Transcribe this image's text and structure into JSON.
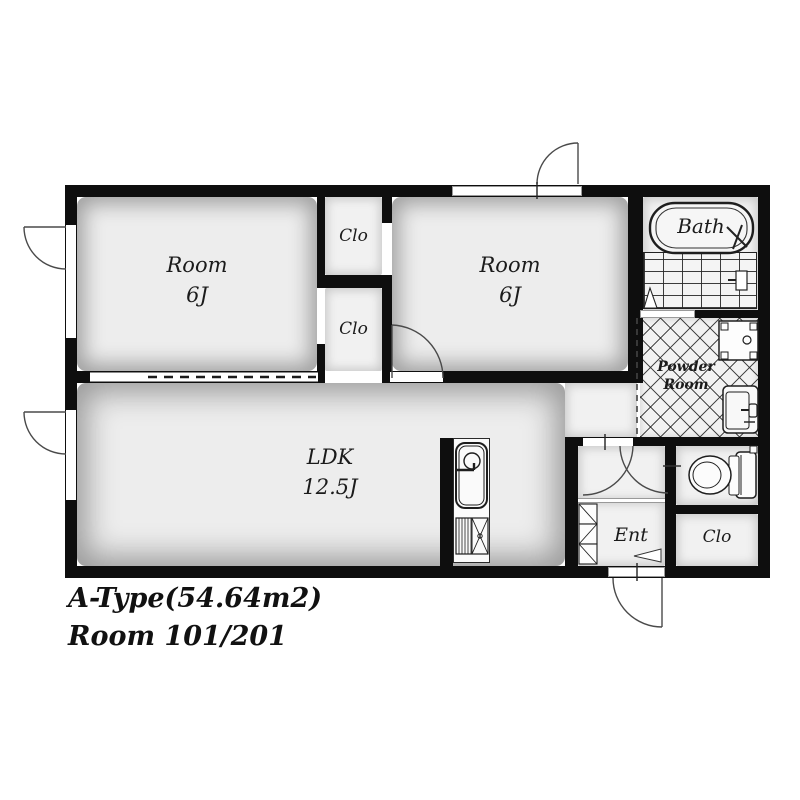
{
  "plan": {
    "title_line1": "A-Type(54.64m2)",
    "title_line2": "Room 101/201",
    "rooms": {
      "room_left": {
        "name": "Room",
        "size": "6J"
      },
      "room_right": {
        "name": "Room",
        "size": "6J"
      },
      "clo_top": {
        "name": "Clo"
      },
      "clo_bottom": {
        "name": "Clo"
      },
      "ldk": {
        "name": "LDK",
        "size": "12.5J"
      },
      "bath": {
        "name": "Bath"
      },
      "powder": {
        "line1": "Powder",
        "line2": "Room"
      },
      "ent": {
        "name": "Ent"
      },
      "clo_entry": {
        "name": "Clo"
      }
    },
    "colors": {
      "wall": "#0e0e0e",
      "floor": "#ededed",
      "line": "#4a4a4a"
    }
  }
}
